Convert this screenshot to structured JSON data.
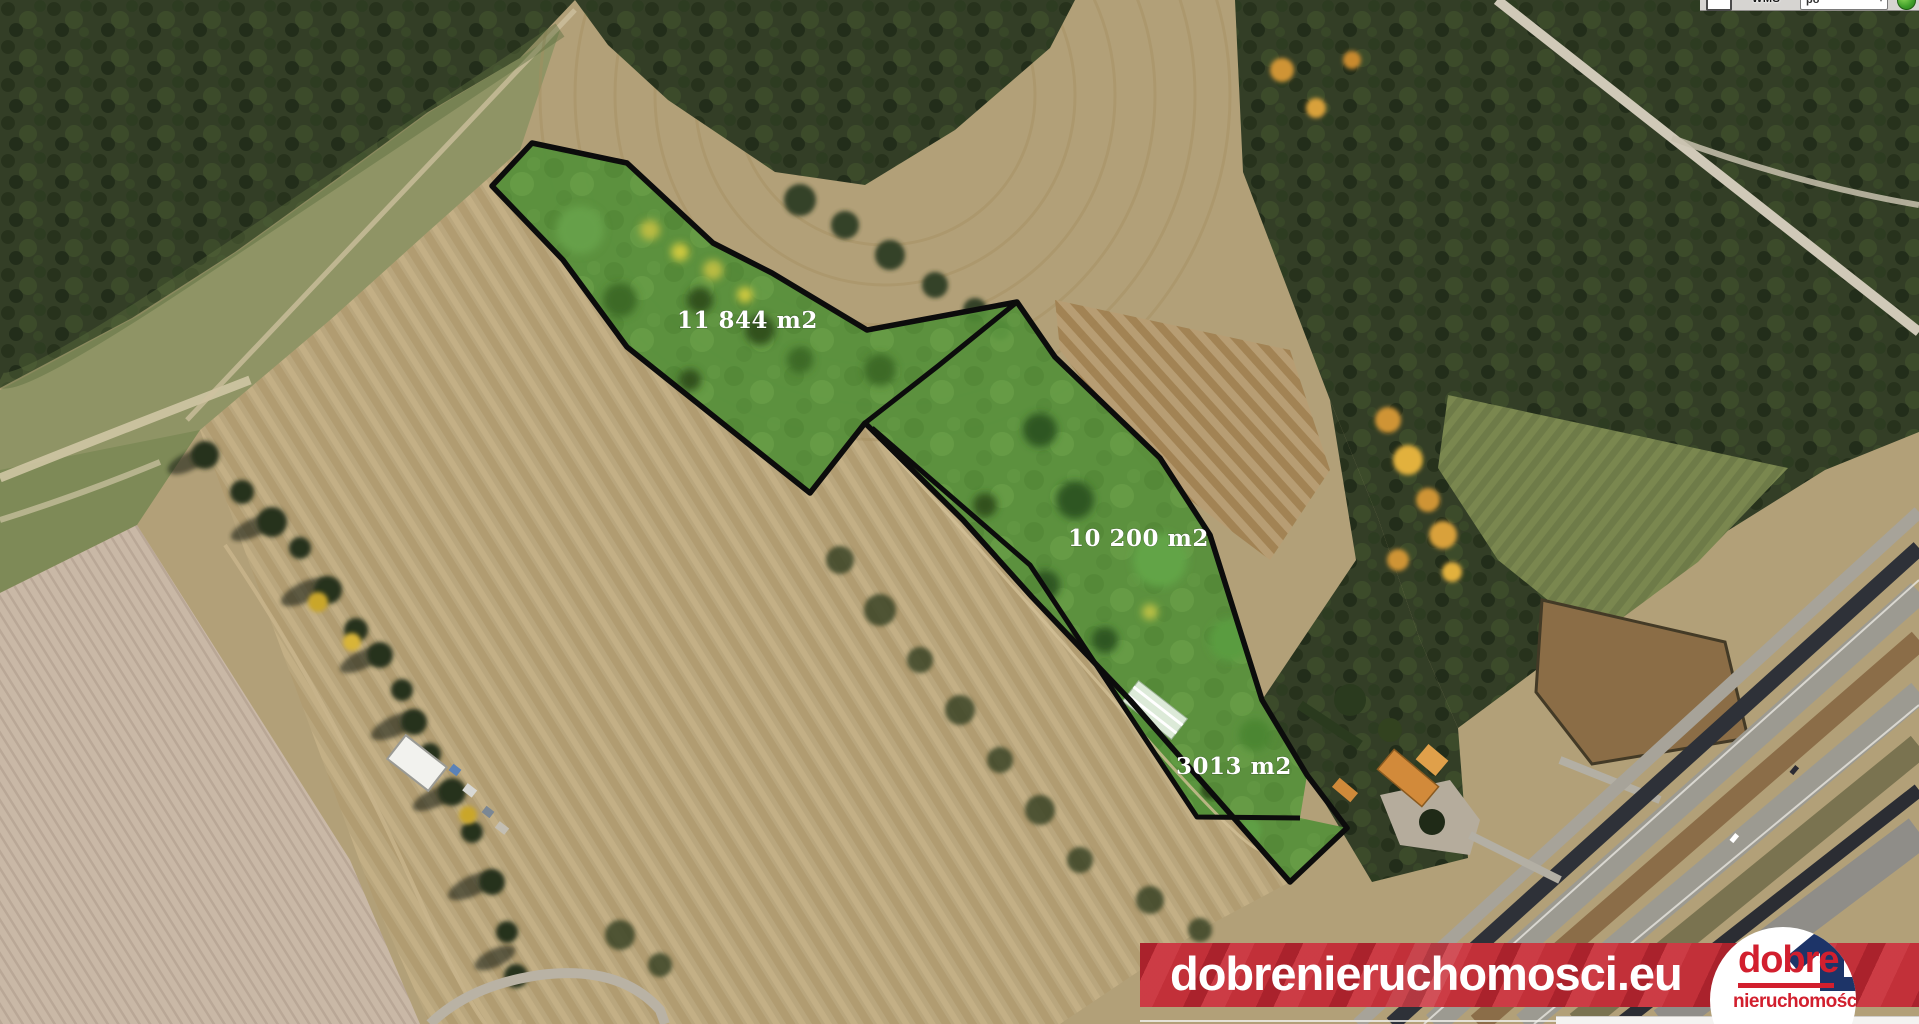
{
  "map": {
    "parcels": [
      {
        "name": "parcel-north",
        "area_label": "11 844 m2"
      },
      {
        "name": "parcel-east",
        "area_label": "10 200 m2"
      },
      {
        "name": "parcel-south-strip",
        "area_label": "3013 m2"
      }
    ],
    "overlay": {
      "fill_color": "#55903a",
      "outline_color": "#0c0c0c"
    }
  },
  "toolbar": {
    "wms_label": "WMS",
    "dropdown_value": "po",
    "dropdown_caret": "▾"
  },
  "watermark": {
    "site_text": "dobrenieruchomosci.eu",
    "logo_top": "dobre",
    "logo_bottom": "nieruchomości",
    "banner_color": "#c23039",
    "logo_red": "#d21f2e",
    "logo_navy": "#1d3468"
  }
}
